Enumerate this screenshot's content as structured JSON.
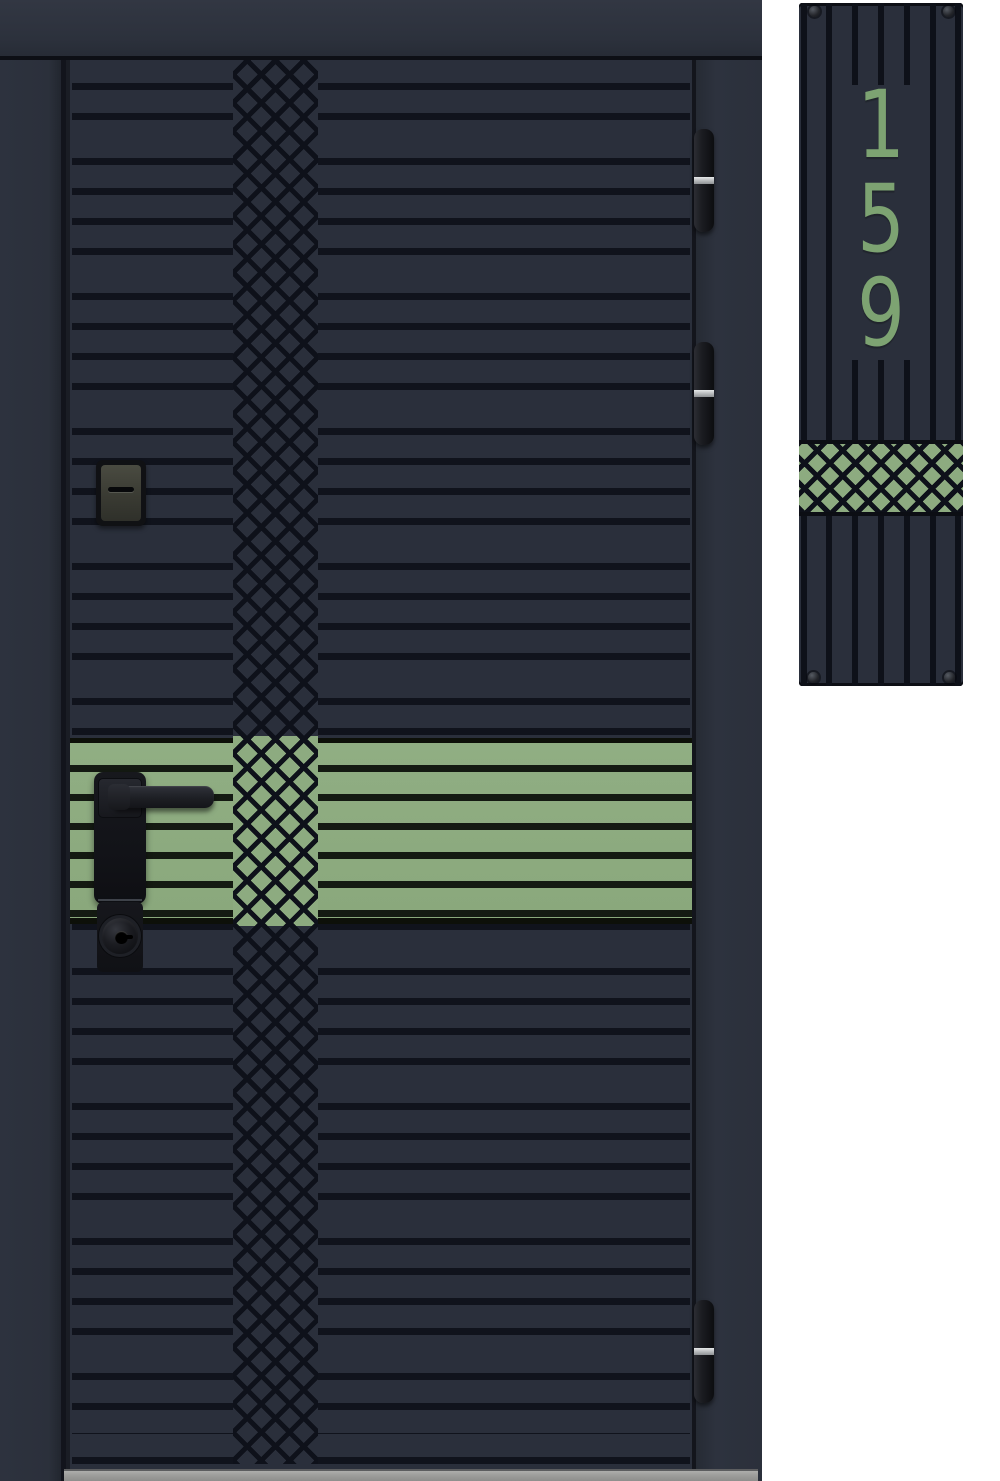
{
  "scene": {
    "subject": "Modern anthracite entrance door with sage-green accent band and matching house number plaque",
    "background": "#ffffff"
  },
  "palette": {
    "door_base": "#2a2f3b",
    "frame": "#2d323e",
    "groove_black": "#10131c",
    "accent_green": "#8dab80",
    "accent_green_groove": "#141a12",
    "digit_green": "#7da372",
    "hardware_black": "#17181d",
    "hinge_silver": "#b9bcbe",
    "threshold_gray": "#9b9b99"
  },
  "door": {
    "pattern": "horizontal slats with central diamond-lattice column",
    "accent_band": "sage-green horizontal band at handle height",
    "hardware": {
      "handle": "black lever handle on long backplate",
      "cylinder": "round keyhole cylinder",
      "aux_lock": "auxiliary lock cover with slot",
      "hinge_count": 3
    }
  },
  "plaque": {
    "number": "159",
    "digits": [
      "1",
      "5",
      "9"
    ],
    "pattern": "vertical slats with green diamond-lattice band",
    "screw_count": 4
  }
}
